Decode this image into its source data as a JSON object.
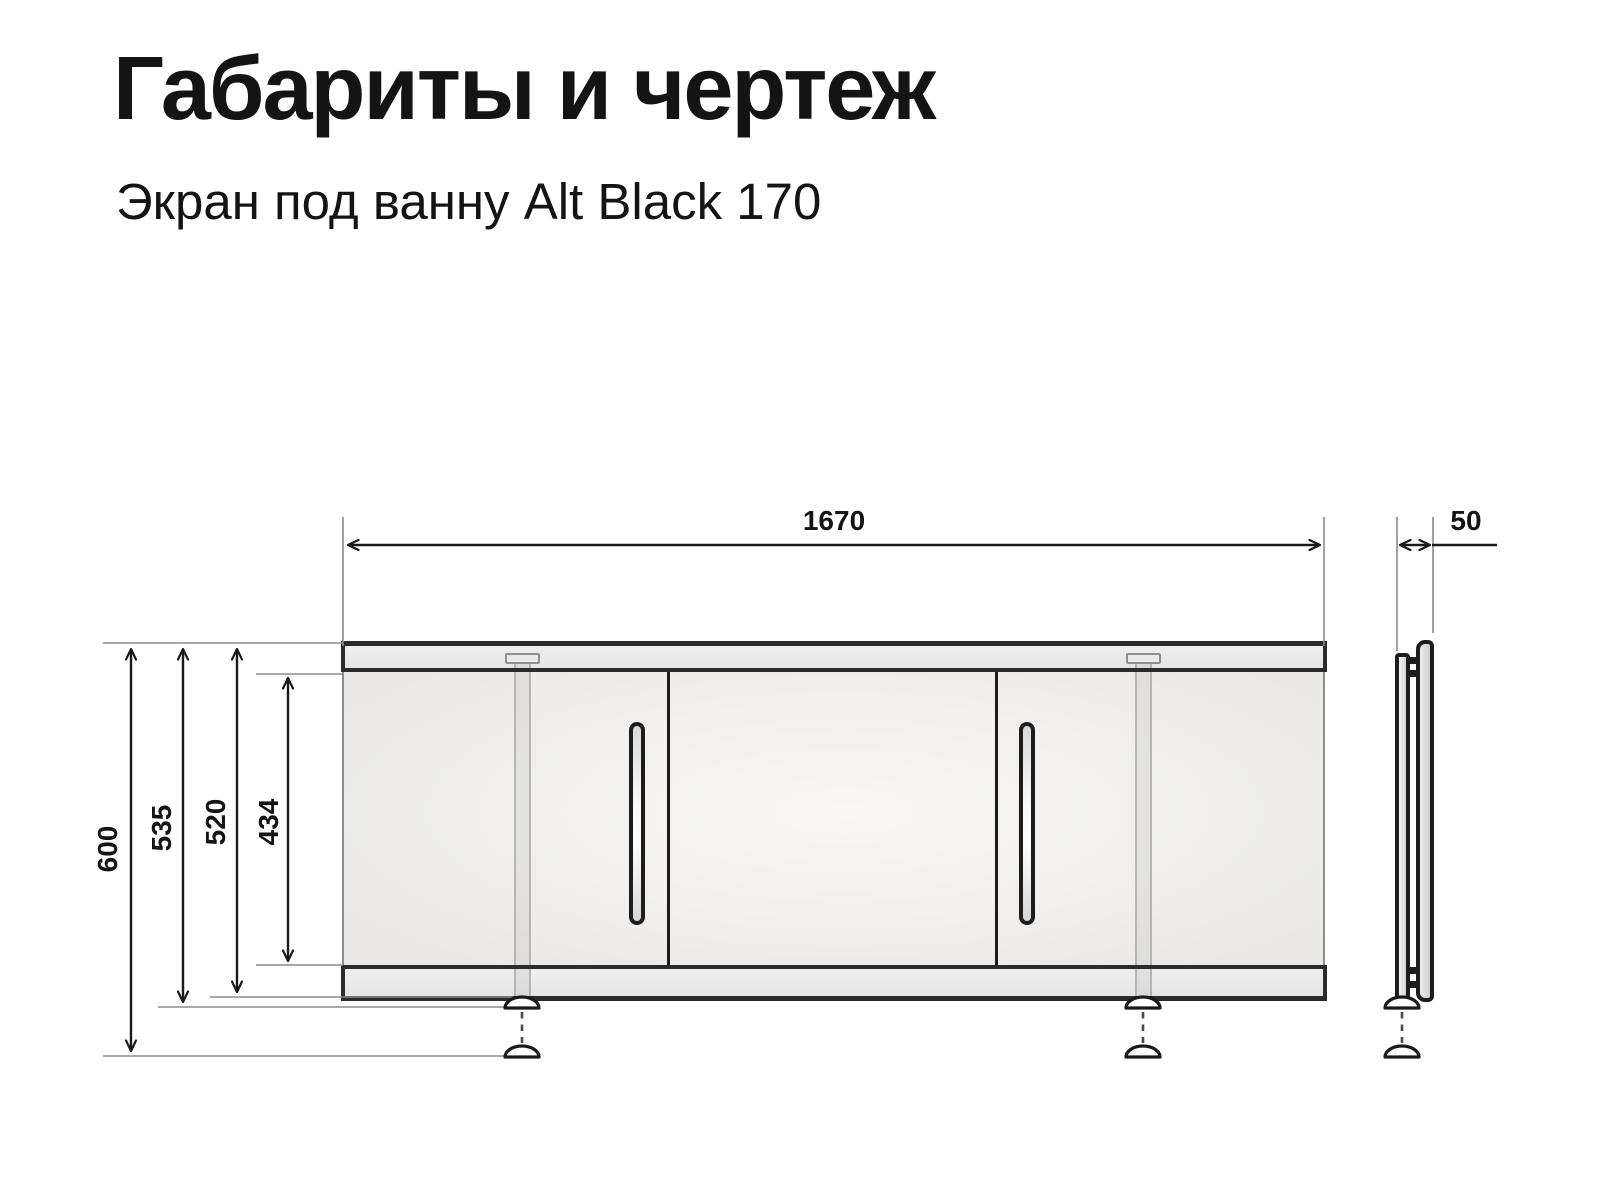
{
  "page": {
    "title": "Габариты и чертеж",
    "subtitle": "Экран под ванну Alt Black 170"
  },
  "dimensions": {
    "width_mm": "1670",
    "depth_mm": "50",
    "height_total_mm": "600",
    "height_with_foot_mm": "535",
    "height_screen_mm": "520",
    "height_door_mm": "434"
  },
  "colors": {
    "text": "#141414",
    "dimension_line": "#1a1a1a",
    "extension_line": "#8c8c8c",
    "panel_fill": "#f0efed",
    "rail_fill": "#e9e9e9",
    "outline": "#1d1d1d"
  }
}
